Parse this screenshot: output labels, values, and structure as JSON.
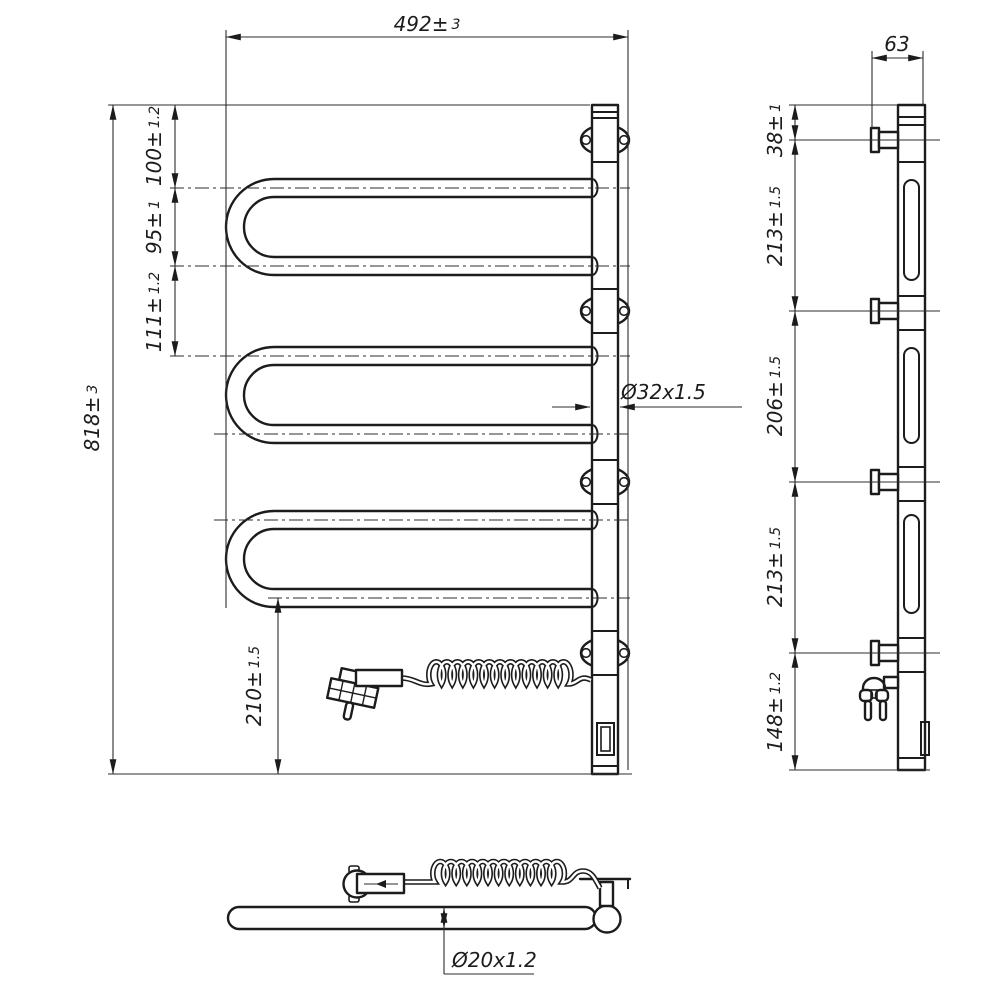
{
  "page": {
    "background": "#ffffff"
  },
  "drawing": {
    "type": "technical-drawing",
    "subject": "electric heated towel rail, three orthographic views",
    "line_color": "#1c1c1c",
    "dims": {
      "width": {
        "v": "492",
        "pm": "±",
        "tol": "3"
      },
      "height": {
        "v": "818",
        "pm": "±",
        "tol": "3"
      },
      "top_offset": {
        "v": "100",
        "pm": "±",
        "tol": "1.2"
      },
      "tube_pitch": {
        "v": "95",
        "pm": "±",
        "tol": "1"
      },
      "loop_gap": {
        "v": "111",
        "pm": "±",
        "tol": "1.2"
      },
      "bottom_offset": {
        "v": "210",
        "pm": "±",
        "tol": "1.5"
      },
      "depth": {
        "v": "63"
      },
      "side_top": {
        "v": "38",
        "pm": "±",
        "tol": "1"
      },
      "span_a": {
        "v": "213",
        "pm": "±",
        "tol": "1.5"
      },
      "span_b": {
        "v": "206",
        "pm": "±",
        "tol": "1.5"
      },
      "span_c": {
        "v": "213",
        "pm": "±",
        "tol": "1.5"
      },
      "side_bottom": {
        "v": "148",
        "pm": "±",
        "tol": "1.2"
      },
      "riser_tube": {
        "v": "Ø32x1.5"
      },
      "rail_tube": {
        "v": "Ø20x1.2"
      }
    }
  }
}
